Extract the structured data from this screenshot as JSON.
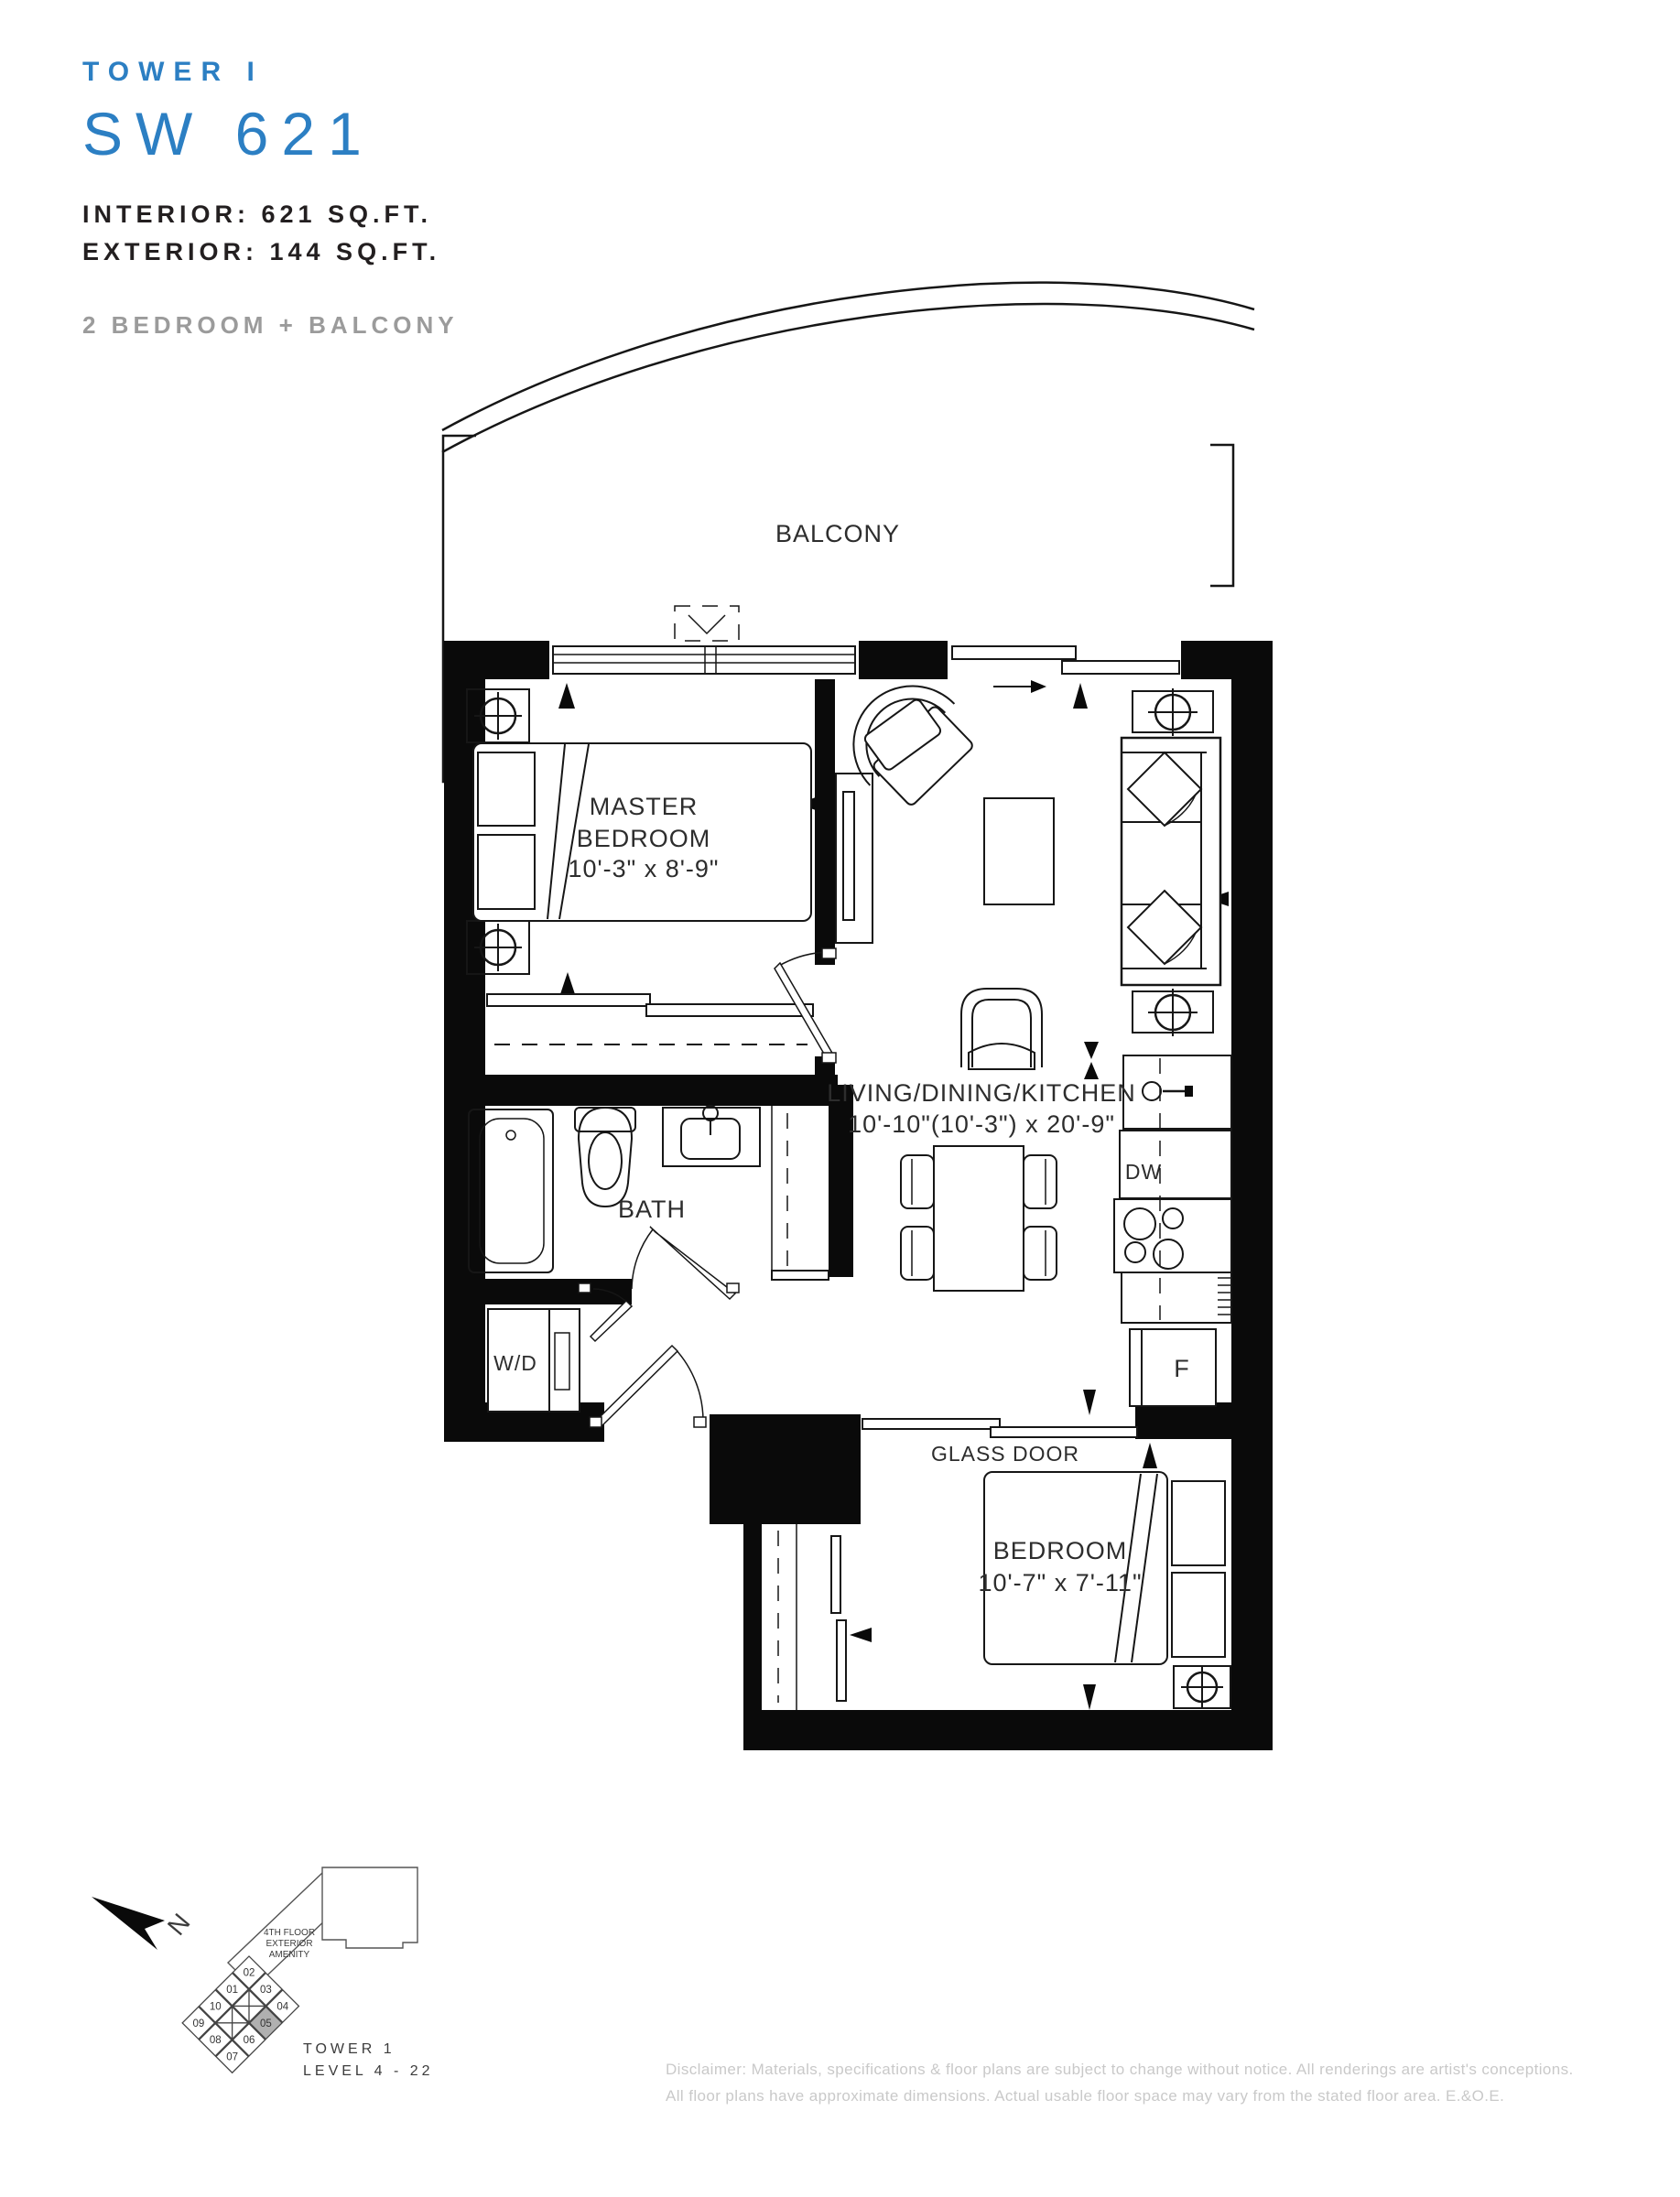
{
  "header": {
    "tower": "TOWER I",
    "unit": "SW 621",
    "interior": "INTERIOR: 621 SQ.FT.",
    "exterior": "EXTERIOR: 144 SQ.FT.",
    "type": "2 BEDROOM + BALCONY"
  },
  "plan": {
    "balcony": "BALCONY",
    "master_line1": "MASTER",
    "master_line2": "BEDROOM",
    "master_dims": "10'-3\" x 8'-9\"",
    "living_name": "LIVING/DINING/KITCHEN",
    "living_dims": "10'-10\"(10'-3\") x 20'-9\"",
    "bath": "BATH",
    "wd": "W/D",
    "dw": "DW",
    "fridge": "F",
    "glass_door": "GLASS DOOR",
    "bedroom_name": "BEDROOM",
    "bedroom_dims": "10'-7\" x 7'-11\""
  },
  "keyplan": {
    "north": "N",
    "amenity_line1": "4TH FLOOR",
    "amenity_line2": "EXTERIOR",
    "amenity_line3": "AMENITY",
    "tower": "TOWER 1",
    "level": "LEVEL 4 - 22",
    "highlighted_unit": "05",
    "units": {
      "u01": "01",
      "u02": "02",
      "u03": "03",
      "u04": "04",
      "u05": "05",
      "u06": "06",
      "u07": "07",
      "u08": "08",
      "u09": "09",
      "u10": "10"
    }
  },
  "footer": {
    "line1": "Disclaimer: Materials, specifications & floor plans are subject to change without notice. All renderings are artist's conceptions.",
    "line2": "All floor plans have approximate dimensions. Actual usable floor space may vary from the stated floor area. E.&O.E."
  },
  "colors": {
    "accent": "#2c7fc3",
    "text": "#231f20",
    "muted": "#9b9b9b",
    "disclaimer": "#c9c9c9",
    "wall": "#0a0a0a",
    "keyplan_highlight": "#b0b0b0"
  }
}
